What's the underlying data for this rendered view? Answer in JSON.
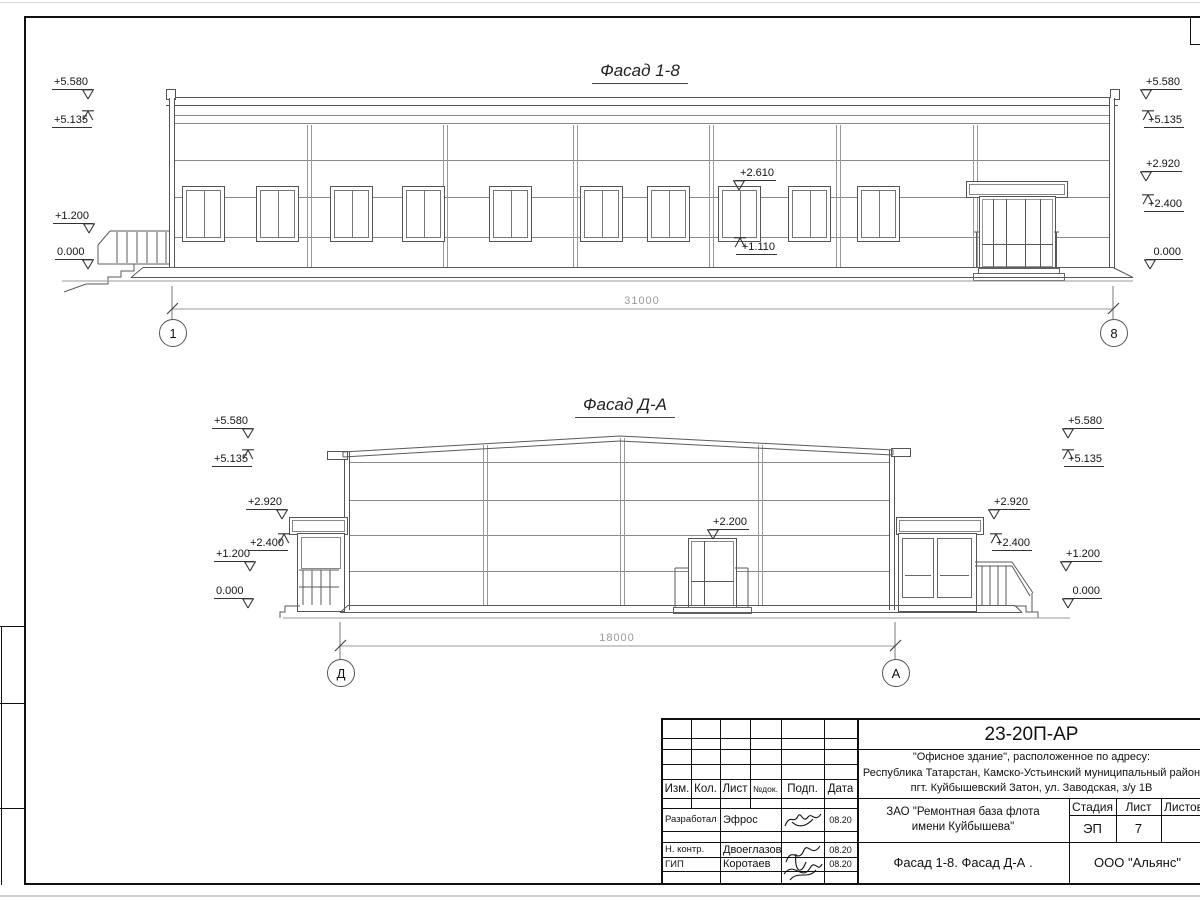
{
  "f18": {
    "title": "Фасад 1-8",
    "left_marks": [
      "+5.580",
      "+5.135",
      "+1.200",
      "0.000"
    ],
    "right_marks": [
      "+5.580",
      "+5.135",
      "+2.920",
      "+2.400",
      "0.000"
    ],
    "window_marks": [
      "+2.610",
      "+1.110"
    ],
    "dimension": "31000",
    "axes": [
      "1",
      "8"
    ]
  },
  "fda": {
    "title": "Фасад Д-А",
    "left_marks": [
      "+5.580",
      "+5.135",
      "+2.920",
      "+2.400",
      "+1.200",
      "0.000"
    ],
    "right_marks": [
      "+2.920",
      "+2.400",
      "+5.580",
      "+5.135",
      "+1.200",
      "0.000"
    ],
    "door_mark": "+2.200",
    "dimension": "18000",
    "axes": [
      "Д",
      "А"
    ]
  },
  "title_block": {
    "code": "23-20П-АР",
    "address": [
      "\"Офисное здание\", расположенное по адресу:",
      "Республика Татарстан, Камско-Устьинский муниципальный район",
      "пгт. Куйбышевский Затон, ул. Заводская, з/у 1В"
    ],
    "client_lines": [
      "ЗАО \"Ремонтная база флота",
      "имени Куйбышева\""
    ],
    "columns": {
      "izm": "Изм.",
      "kol": "Кол.",
      "list": "Лист",
      "ndok": "№док.",
      "podp": "Подп.",
      "data": "Дата"
    },
    "rows": [
      {
        "role": "Разработал",
        "name": "Эфрос",
        "date": "08.20"
      },
      {
        "role": "Н. контр.",
        "name": "Двоеглазов",
        "date": "08.20"
      },
      {
        "role": "ГИП",
        "name": "Коротаев",
        "date": "08.20"
      }
    ],
    "stage_label": "Стадия",
    "sheet_label": "Лист",
    "sheets_label": "Листов",
    "stage": "ЭП",
    "sheet_number": "7",
    "sheets_total": "",
    "doc_title": "Фасад 1-8. Фасад Д-А .",
    "org": "ООО \"Альянс\""
  }
}
